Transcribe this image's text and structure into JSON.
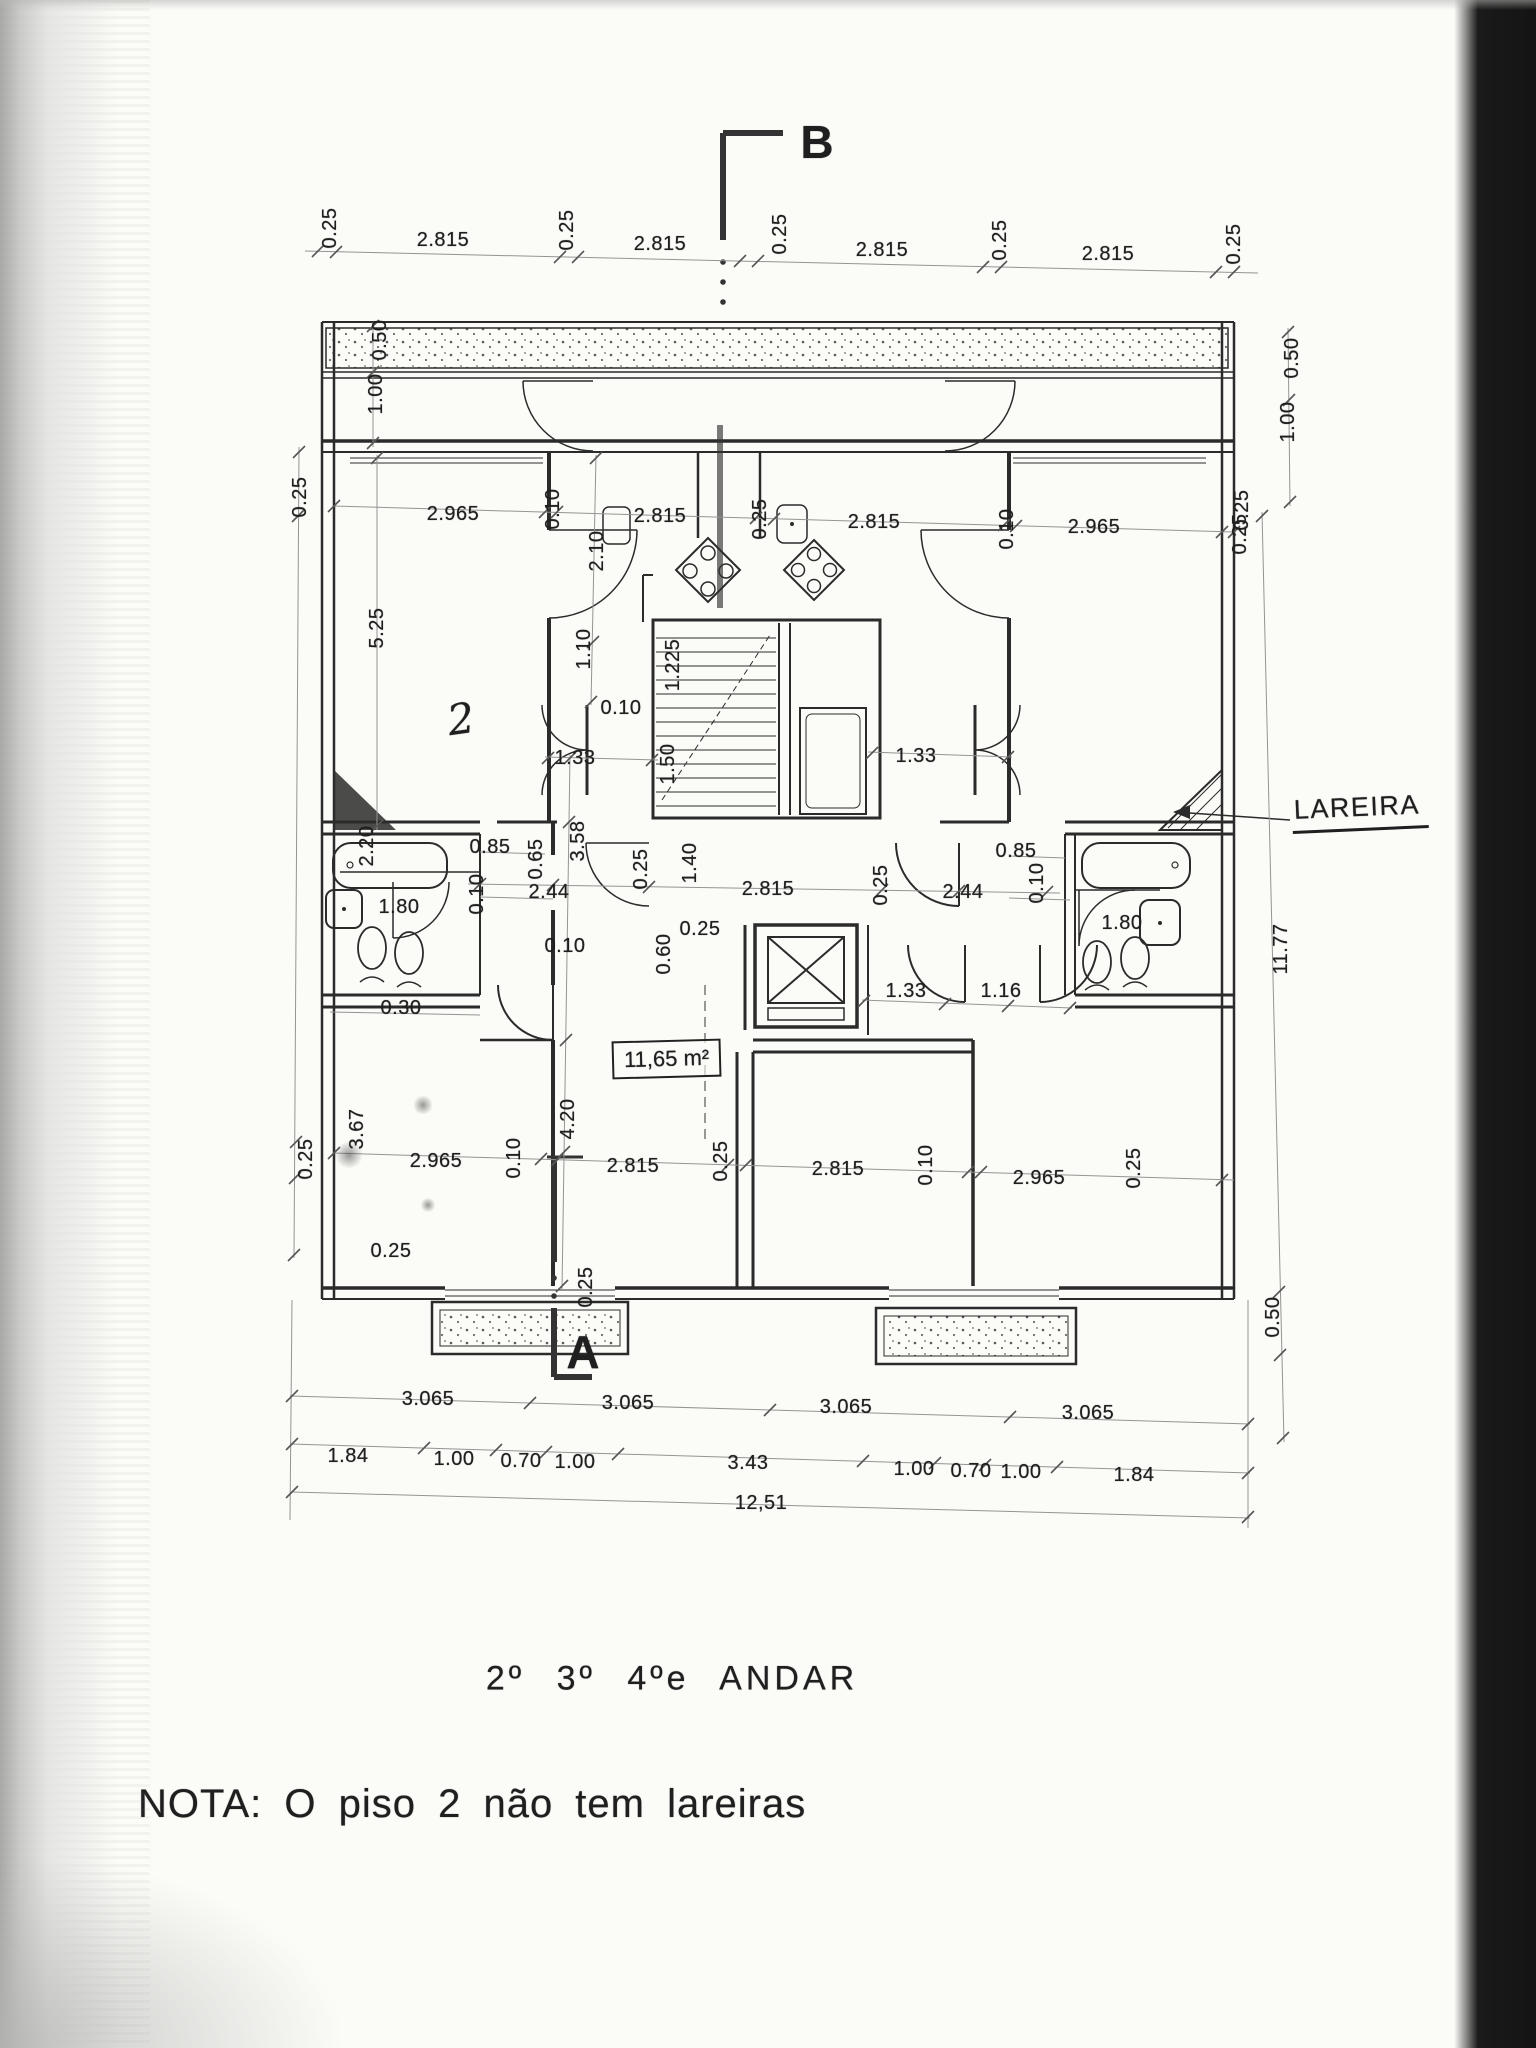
{
  "annotations": {
    "section_b": "B",
    "section_a": "A",
    "fireplace": "LAREIRA",
    "area": "11,65 m²",
    "handwritten": "2",
    "title": "2º 3º 4ºe ANDAR",
    "note": "NOTA: O piso 2 não tem lareiras"
  },
  "colors": {
    "ink": "#2b2b2b",
    "dim_line": "#949494",
    "paper": "#fbfbf8",
    "scan_edge": "#1a1a1a"
  },
  "labels": [
    {
      "text": "0.25",
      "x": 330,
      "y": 228,
      "rot": -90
    },
    {
      "text": "2.815",
      "x": 443,
      "y": 240,
      "rot": 0
    },
    {
      "text": "0.25",
      "x": 567,
      "y": 230,
      "rot": -90
    },
    {
      "text": "2.815",
      "x": 660,
      "y": 244,
      "rot": 0
    },
    {
      "text": "0.25",
      "x": 780,
      "y": 234,
      "rot": -90
    },
    {
      "text": "2.815",
      "x": 882,
      "y": 250,
      "rot": 0
    },
    {
      "text": "0.25",
      "x": 1000,
      "y": 240,
      "rot": -90
    },
    {
      "text": "2.815",
      "x": 1108,
      "y": 254,
      "rot": 0
    },
    {
      "text": "0.25",
      "x": 1234,
      "y": 244,
      "rot": -90
    },
    {
      "text": "0.50",
      "x": 380,
      "y": 340,
      "rot": -90
    },
    {
      "text": "1.00",
      "x": 376,
      "y": 394,
      "rot": -90
    },
    {
      "text": "0.25",
      "x": 300,
      "y": 497,
      "rot": -90
    },
    {
      "text": "0.50",
      "x": 1292,
      "y": 358,
      "rot": -90
    },
    {
      "text": "1.00",
      "x": 1288,
      "y": 422,
      "rot": -90
    },
    {
      "text": "0.25",
      "x": 1242,
      "y": 510,
      "rot": -90
    },
    {
      "text": "2.965",
      "x": 453,
      "y": 514,
      "rot": 0
    },
    {
      "text": "0.10",
      "x": 553,
      "y": 509,
      "rot": -90
    },
    {
      "text": "2.815",
      "x": 660,
      "y": 516,
      "rot": 0
    },
    {
      "text": "0.25",
      "x": 760,
      "y": 519,
      "rot": -90
    },
    {
      "text": "2.815",
      "x": 874,
      "y": 522,
      "rot": 0
    },
    {
      "text": "0.10",
      "x": 1007,
      "y": 529,
      "rot": -90
    },
    {
      "text": "2.965",
      "x": 1094,
      "y": 527,
      "rot": 0
    },
    {
      "text": "0.25",
      "x": 1240,
      "y": 534,
      "rot": -90
    },
    {
      "text": "2.10",
      "x": 597,
      "y": 551,
      "rot": -90
    },
    {
      "text": "5.25",
      "x": 377,
      "y": 628,
      "rot": -90
    },
    {
      "text": "1.10",
      "x": 584,
      "y": 649,
      "rot": -90
    },
    {
      "text": "1.225",
      "x": 673,
      "y": 665,
      "rot": -90
    },
    {
      "text": "0.10",
      "x": 621,
      "y": 708,
      "rot": 0
    },
    {
      "text": "1.33",
      "x": 575,
      "y": 758,
      "rot": 0
    },
    {
      "text": "1.50",
      "x": 668,
      "y": 764,
      "rot": -90
    },
    {
      "text": "1.33",
      "x": 916,
      "y": 756,
      "rot": 0
    },
    {
      "text": "3.58",
      "x": 578,
      "y": 841,
      "rot": -90
    },
    {
      "text": "0.65",
      "x": 536,
      "y": 859,
      "rot": -90
    },
    {
      "text": "0.85",
      "x": 490,
      "y": 847,
      "rot": 0
    },
    {
      "text": "2.20",
      "x": 367,
      "y": 846,
      "rot": -90
    },
    {
      "text": "2.44",
      "x": 549,
      "y": 892,
      "rot": 0
    },
    {
      "text": "0.10",
      "x": 477,
      "y": 894,
      "rot": -90
    },
    {
      "text": "1.80",
      "x": 399,
      "y": 907,
      "rot": 0
    },
    {
      "text": "0.30",
      "x": 401,
      "y": 1008,
      "rot": 0
    },
    {
      "text": "0.25",
      "x": 641,
      "y": 869,
      "rot": -90
    },
    {
      "text": "1.40",
      "x": 690,
      "y": 863,
      "rot": -90
    },
    {
      "text": "2.815",
      "x": 768,
      "y": 889,
      "rot": 0
    },
    {
      "text": "0.25",
      "x": 881,
      "y": 885,
      "rot": -90
    },
    {
      "text": "2.44",
      "x": 963,
      "y": 892,
      "rot": 0
    },
    {
      "text": "0.85",
      "x": 1016,
      "y": 851,
      "rot": 0
    },
    {
      "text": "0.10",
      "x": 1037,
      "y": 883,
      "rot": -90
    },
    {
      "text": "1.80",
      "x": 1122,
      "y": 923,
      "rot": 0
    },
    {
      "text": "0.10",
      "x": 565,
      "y": 946,
      "rot": 0
    },
    {
      "text": "0.25",
      "x": 700,
      "y": 929,
      "rot": 0
    },
    {
      "text": "0.60",
      "x": 664,
      "y": 954,
      "rot": -90
    },
    {
      "text": "1.33",
      "x": 906,
      "y": 991,
      "rot": 0
    },
    {
      "text": "1.16",
      "x": 1001,
      "y": 991,
      "rot": 0
    },
    {
      "text": "11.77",
      "x": 1281,
      "y": 949,
      "rot": -90
    },
    {
      "text": "3.67",
      "x": 357,
      "y": 1129,
      "rot": -90
    },
    {
      "text": "4.20",
      "x": 568,
      "y": 1119,
      "rot": -90
    },
    {
      "text": "0.25",
      "x": 306,
      "y": 1159,
      "rot": -90
    },
    {
      "text": "2.965",
      "x": 436,
      "y": 1161,
      "rot": 0
    },
    {
      "text": "0.10",
      "x": 514,
      "y": 1158,
      "rot": -90
    },
    {
      "text": "2.815",
      "x": 633,
      "y": 1166,
      "rot": 0
    },
    {
      "text": "0.25",
      "x": 721,
      "y": 1161,
      "rot": -90
    },
    {
      "text": "2.815",
      "x": 838,
      "y": 1169,
      "rot": 0
    },
    {
      "text": "0.10",
      "x": 926,
      "y": 1165,
      "rot": -90
    },
    {
      "text": "2.965",
      "x": 1039,
      "y": 1178,
      "rot": 0
    },
    {
      "text": "0.25",
      "x": 1134,
      "y": 1168,
      "rot": -90
    },
    {
      "text": "0.25",
      "x": 391,
      "y": 1251,
      "rot": 0
    },
    {
      "text": "0.25",
      "x": 586,
      "y": 1287,
      "rot": -90
    },
    {
      "text": "0.50",
      "x": 1273,
      "y": 1317,
      "rot": -90
    },
    {
      "text": "3.065",
      "x": 428,
      "y": 1399,
      "rot": 0
    },
    {
      "text": "3.065",
      "x": 628,
      "y": 1403,
      "rot": 0
    },
    {
      "text": "3.065",
      "x": 846,
      "y": 1407,
      "rot": 0
    },
    {
      "text": "3.065",
      "x": 1088,
      "y": 1413,
      "rot": 0
    },
    {
      "text": "1.84",
      "x": 348,
      "y": 1456,
      "rot": 0
    },
    {
      "text": "1.00",
      "x": 454,
      "y": 1459,
      "rot": 0
    },
    {
      "text": "0.70",
      "x": 521,
      "y": 1461,
      "rot": 0
    },
    {
      "text": "1.00",
      "x": 575,
      "y": 1462,
      "rot": 0
    },
    {
      "text": "3.43",
      "x": 748,
      "y": 1463,
      "rot": 0
    },
    {
      "text": "1.00",
      "x": 914,
      "y": 1469,
      "rot": 0
    },
    {
      "text": "0.70",
      "x": 971,
      "y": 1471,
      "rot": 0
    },
    {
      "text": "1.00",
      "x": 1021,
      "y": 1472,
      "rot": 0
    },
    {
      "text": "1.84",
      "x": 1134,
      "y": 1475,
      "rot": 0
    },
    {
      "text": "12,51",
      "x": 761,
      "y": 1503,
      "rot": 0
    }
  ]
}
